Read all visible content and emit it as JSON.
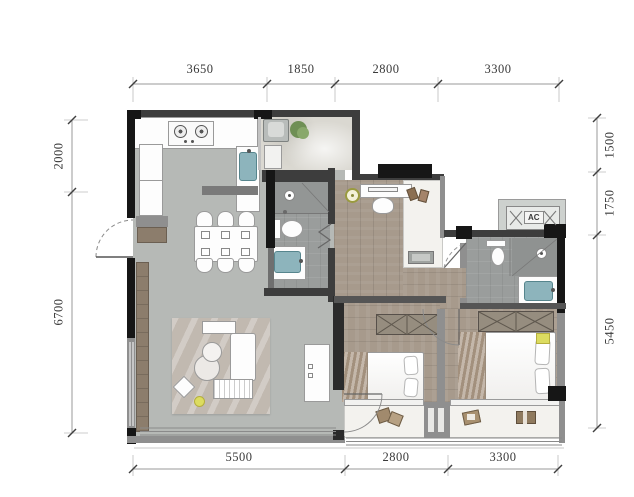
{
  "dimensions": {
    "top": [
      "3650",
      "1850",
      "2800",
      "3300"
    ],
    "bottom": [
      "5500",
      "2800",
      "3300"
    ],
    "left": [
      "2000",
      "6700"
    ],
    "right": [
      "1500",
      "1750",
      "5450"
    ]
  },
  "labels": {
    "ac": "AC"
  },
  "fixtures": [
    "cooktop",
    "kitchen-sink",
    "dining-table",
    "dining-chair",
    "entry-door",
    "tv-console",
    "rug",
    "sofa",
    "ottoman",
    "coffee-table",
    "side-table",
    "stool",
    "washing-machine",
    "plant",
    "shower",
    "toilet",
    "wash-basin",
    "bifold-door",
    "desk",
    "desk-chair",
    "ceiling-lamp",
    "ac-unit",
    "vent",
    "wardrobe",
    "double-bed",
    "pillow",
    "nightstand-cushion",
    "balcony-seat",
    "window",
    "railing"
  ],
  "colors": {
    "wall_dark": "#161616",
    "wall_mid": "#3d3d3d",
    "wall_gray": "#8f8f8f",
    "floor_living": "#b6b9b6",
    "floor_wood": "#a79a8c",
    "floor_tile": "#9a9d9c",
    "floor_balcony": "#f3f2ee",
    "floor_utility": "#dad8d1",
    "rug": "#c1b9b0",
    "brown": "#8c7d6c",
    "basin_blue": "#8db4bc",
    "accent_yellow": "#dcdc60",
    "plant_green": "#7d9c60",
    "furn_border": "#9a9a9a",
    "dimtext": "#3a3a3a"
  }
}
